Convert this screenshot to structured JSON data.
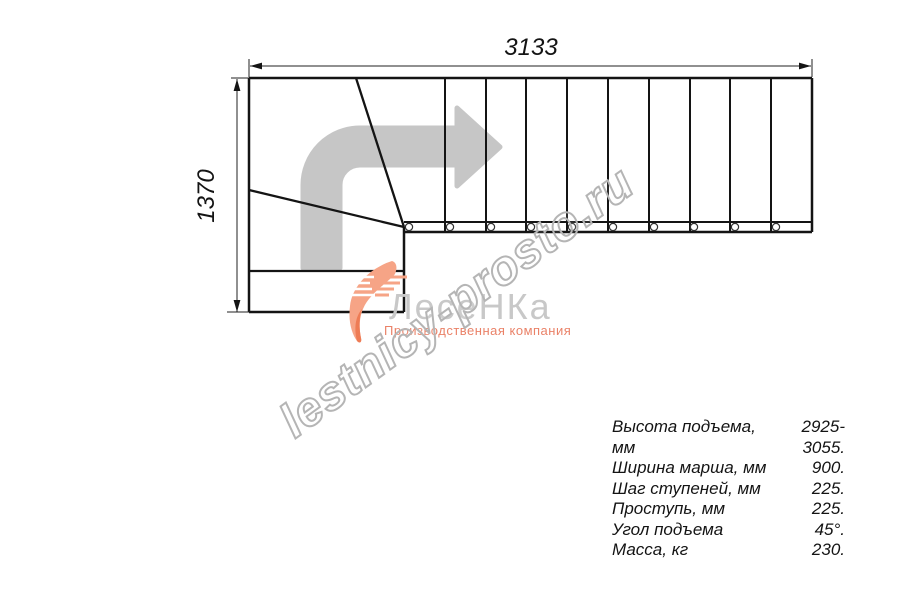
{
  "drawing": {
    "title_dimensions": {
      "width_label": "3133",
      "height_label": "1370"
    },
    "straight_steps_count": 10,
    "baluster_marks_count": 10,
    "turn": "90-degree left-to-right quarter turn with winder steps"
  },
  "watermark": {
    "text": "lestnicy-prosto.ru"
  },
  "logo": {
    "brand": "ЛесеНКа",
    "tagline": "Производственная компания"
  },
  "specs": {
    "rows": [
      {
        "label": "Высота подъема, мм",
        "value": "2925-3055."
      },
      {
        "label": "Ширина марша, мм",
        "value": "900."
      },
      {
        "label": "Шаг ступеней, мм",
        "value": "225."
      },
      {
        "label": "Проступь, мм",
        "value": "225."
      },
      {
        "label": "Угол подъема",
        "value": "45°."
      },
      {
        "label": "Масса, кг",
        "value": "230."
      }
    ]
  },
  "colors": {
    "line": "#141414",
    "direction_arrow": "#c6c6c6",
    "brand_text": "#c8c8c8",
    "tagline": "#ea8268",
    "watermark_outline": "#b5b5b5",
    "background": "#ffffff"
  }
}
